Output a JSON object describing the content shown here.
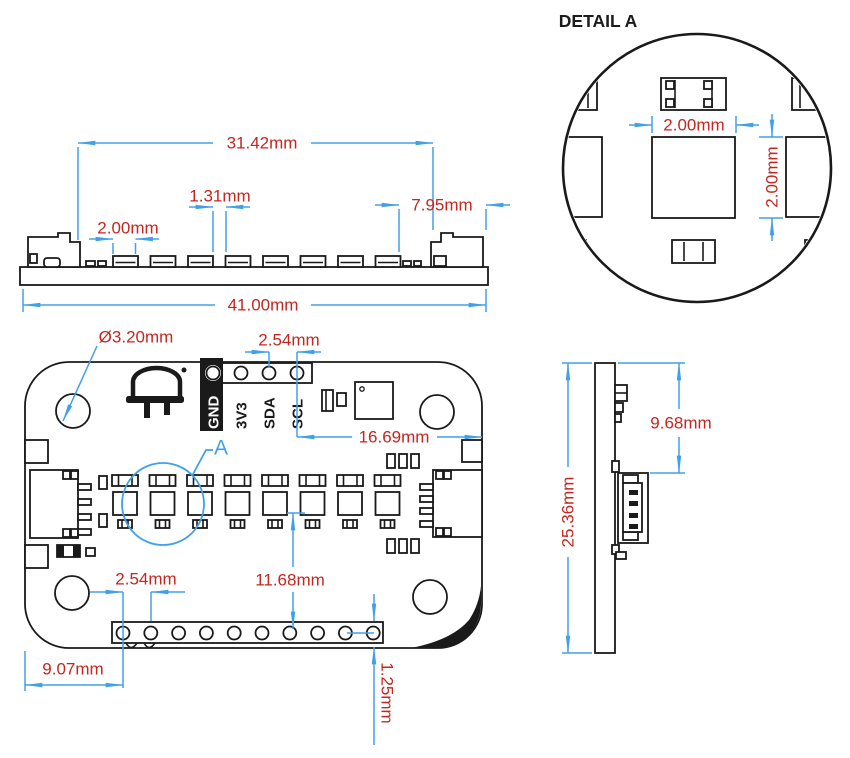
{
  "detail_view": {
    "title": "DETAIL A",
    "dim_width": "2.00mm",
    "dim_height": "2.00mm"
  },
  "top_side_view": {
    "dim_connector_span": "31.42mm",
    "dim_led_gap": "1.31mm",
    "dim_led_width": "2.00mm",
    "dim_right_connector": "7.95mm",
    "dim_board_width": "41.00mm"
  },
  "front_view": {
    "dim_mount_hole": "Ø3.20mm",
    "dim_header_pitch": "2.54mm",
    "dim_scl_to_edge": "16.69mm",
    "dim_led_to_holes": "11.68mm",
    "dim_bottom_pitch": "2.54mm",
    "dim_edge_to_hole": "9.07mm",
    "dim_hole_to_edge": "1.25mm",
    "detail_callout": "A",
    "pin_labels": [
      "GND",
      "3V3",
      "SDA",
      "SCL"
    ]
  },
  "right_side_view": {
    "dim_board_height": "25.36mm",
    "dim_top_to_connector": "9.68mm"
  },
  "colors": {
    "dim_line": "#42a0e8",
    "dim_text": "#c5261f",
    "drawing": "#1a1a1a"
  }
}
